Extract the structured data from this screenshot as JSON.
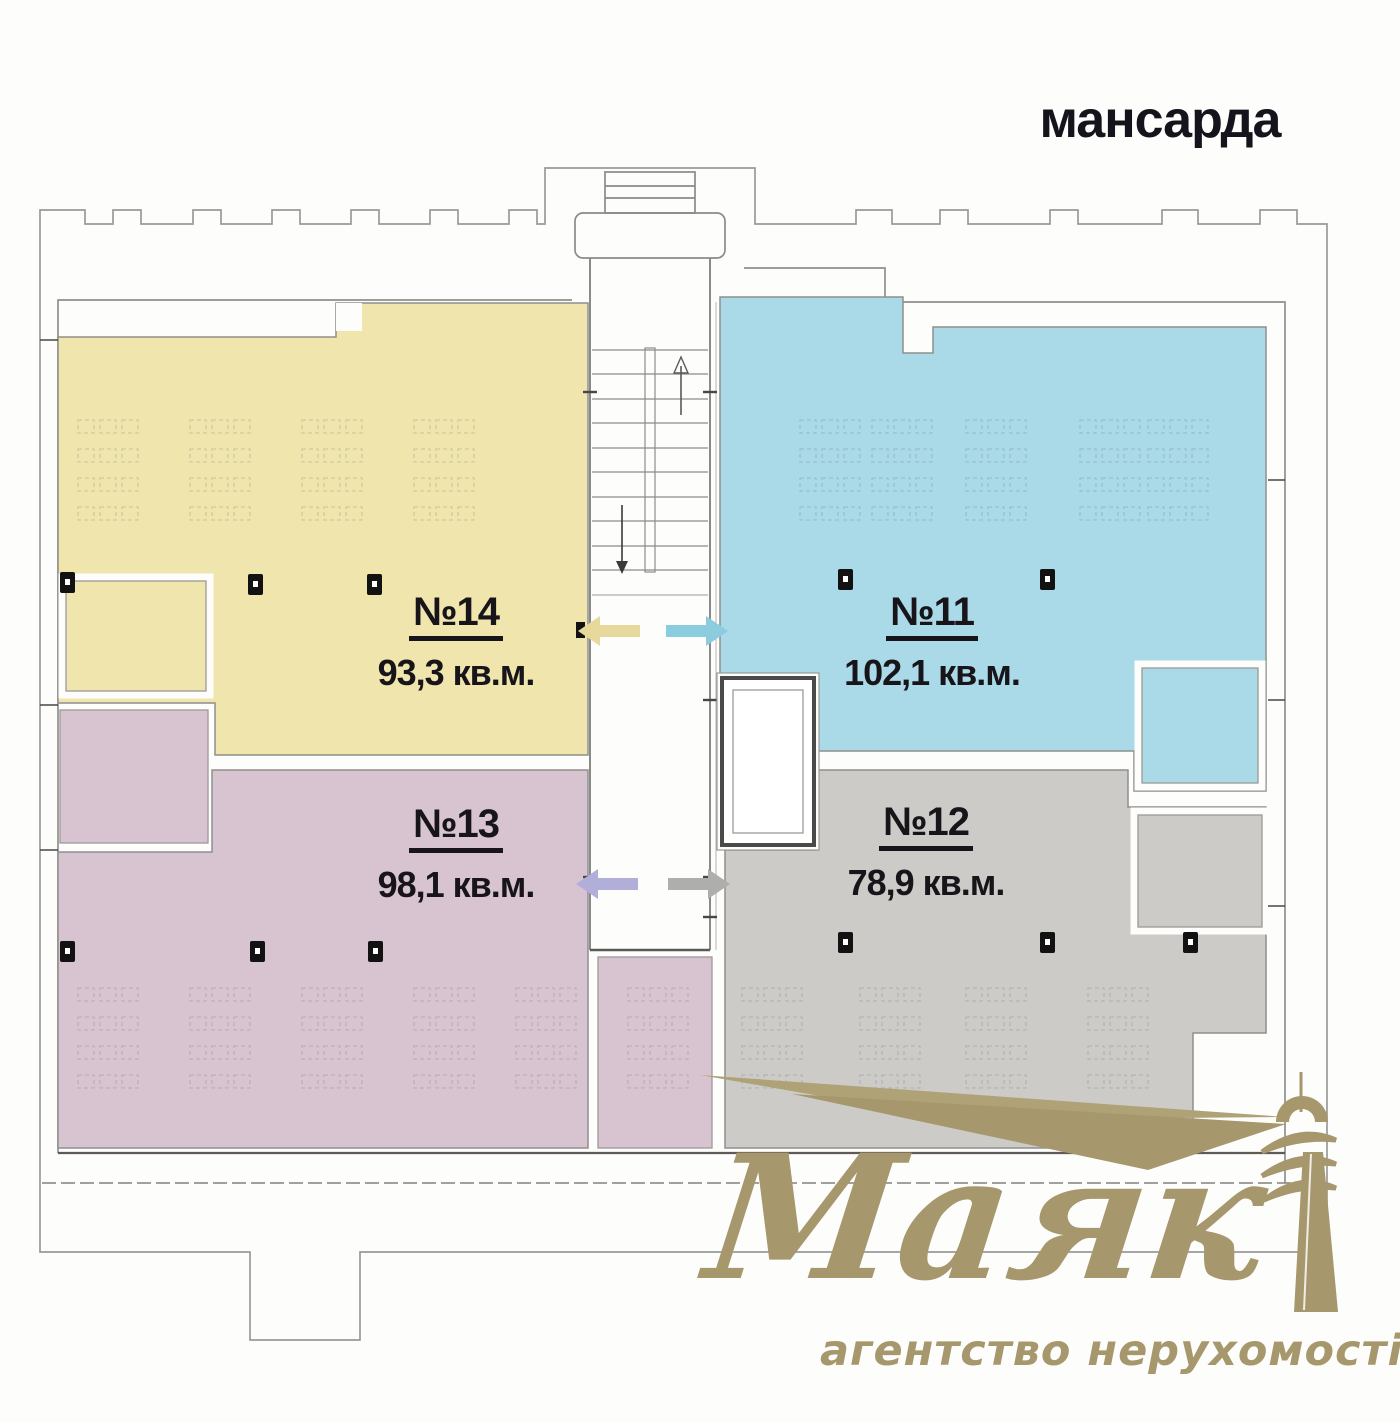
{
  "title": "мансарда",
  "units": [
    {
      "number": "№14",
      "area": "93,3 кв.м.",
      "color": "#efe5ad",
      "arrow_color": "#e7d99c"
    },
    {
      "number": "№11",
      "area": "102,1 кв.м.",
      "color": "#aad9e7",
      "arrow_color": "#8cccdf"
    },
    {
      "number": "№13",
      "area": "98,1 кв.м.",
      "color": "#d8c4d0",
      "arrow_color": "#b1aeda"
    },
    {
      "number": "№12",
      "area": "78,9 кв.м.",
      "color": "#cccbc8",
      "arrow_color": "#aeaeac"
    }
  ],
  "logo": {
    "name": "Маяк",
    "tagline": "агентство нерухомості",
    "color": "#a6976c",
    "beam_color": "#b0a277"
  },
  "plan": {
    "wall_color": "#8f8f8d",
    "dark_wall_color": "#55504d",
    "background": "#fdfdfc"
  }
}
